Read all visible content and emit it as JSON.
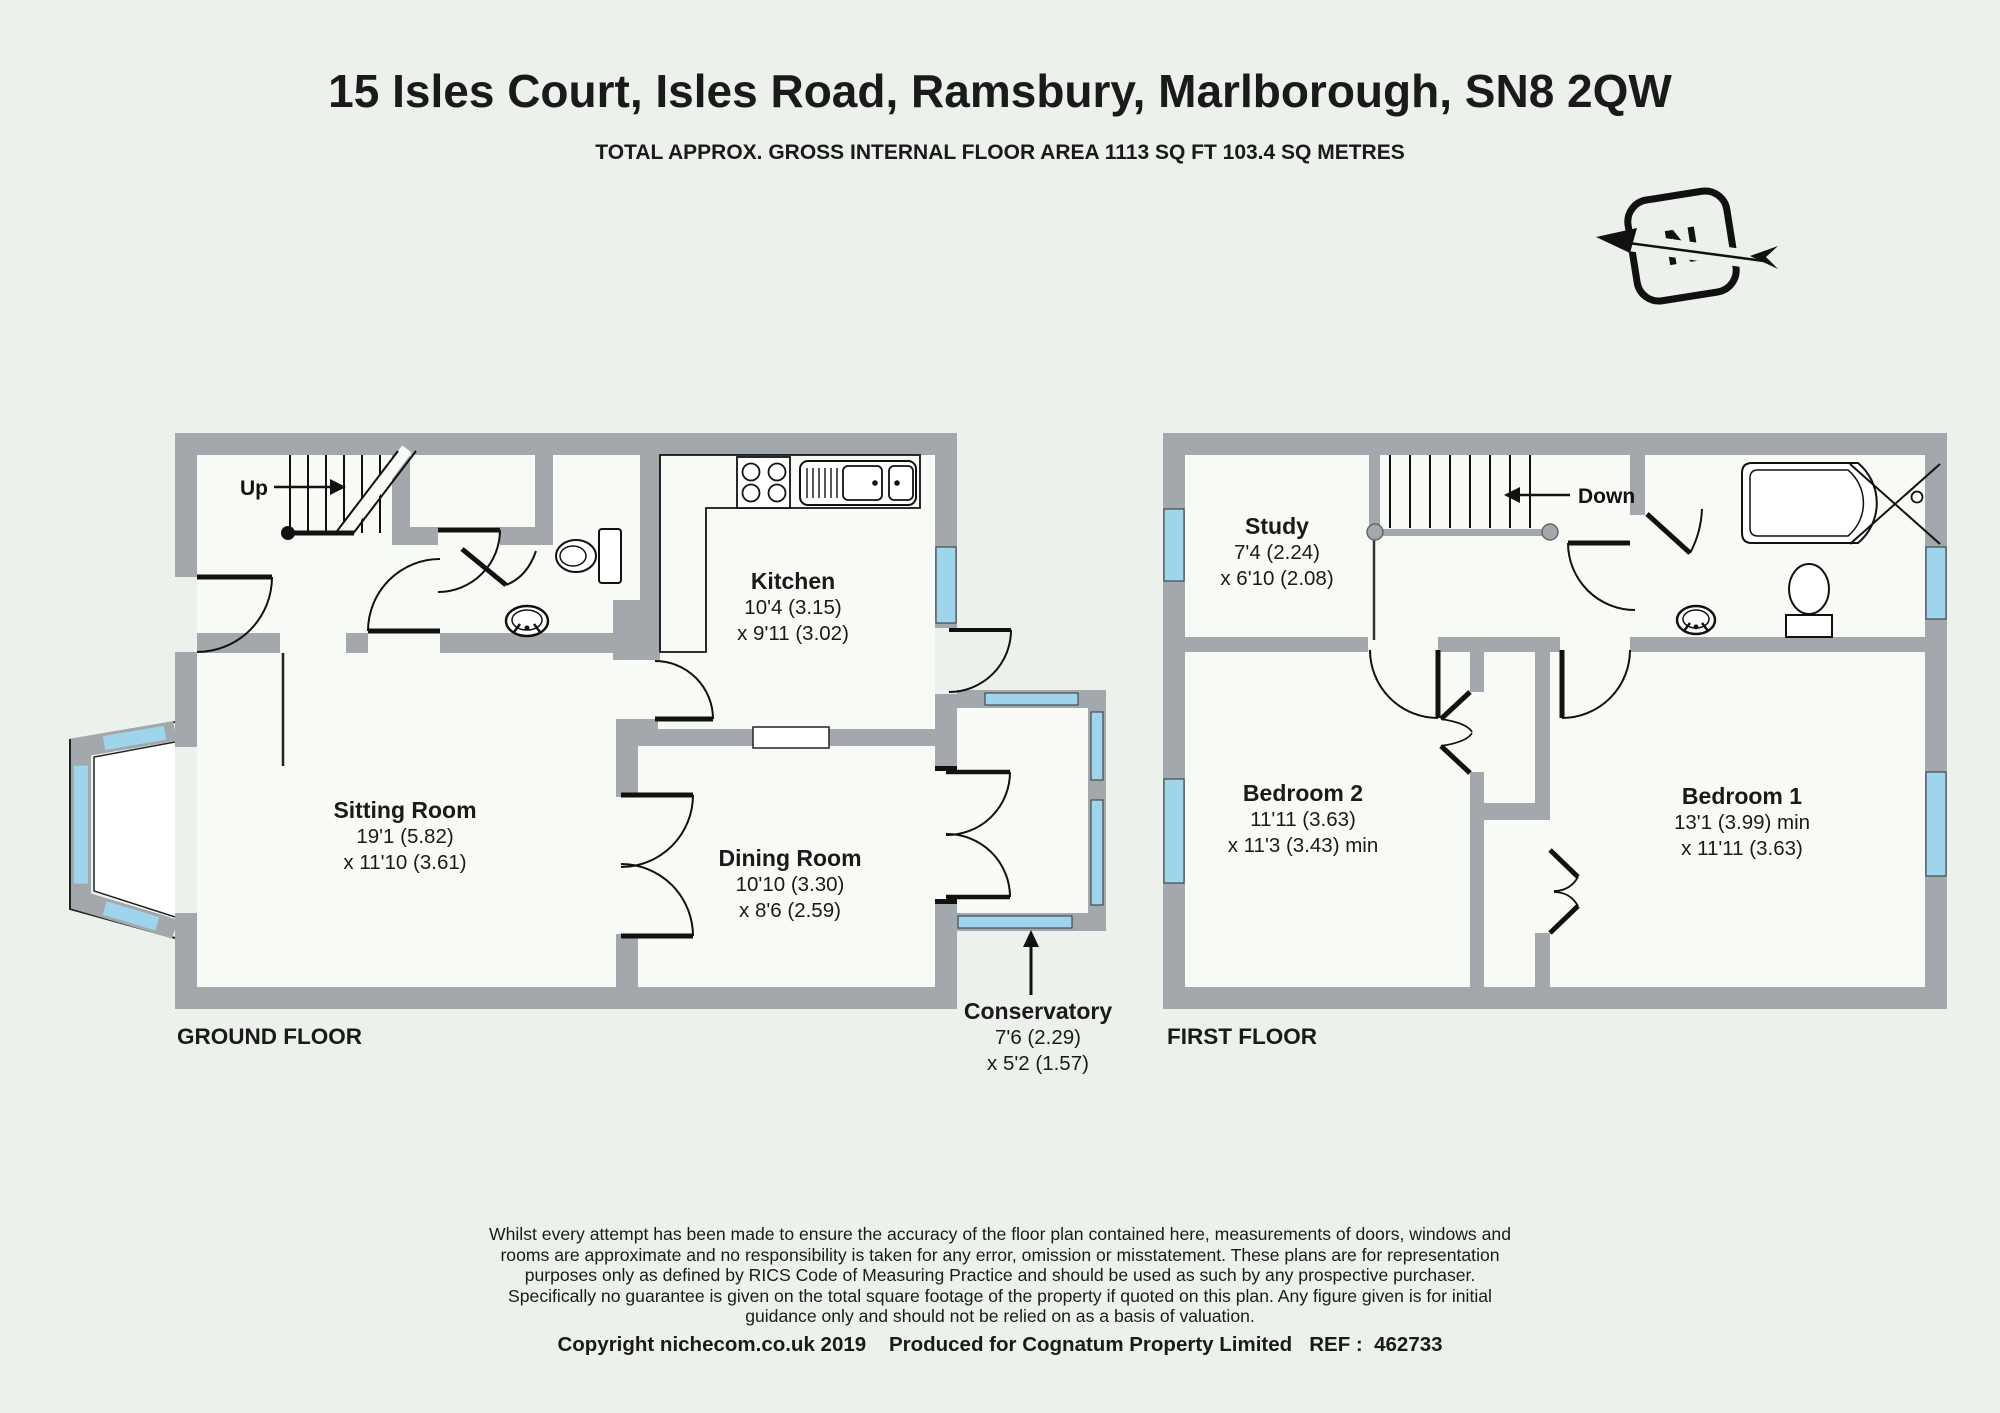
{
  "header": {
    "title": "15 Isles Court, Isles Road, Ramsbury, Marlborough, SN8 2QW",
    "subtitle": "TOTAL APPROX. GROSS INTERNAL FLOOR AREA 1113 SQ FT 103.4 SQ METRES"
  },
  "compass": {
    "letter": "N"
  },
  "ground_floor": {
    "label": "GROUND FLOOR",
    "stairs_direction": "Up",
    "rooms": {
      "sitting": {
        "name": "Sitting Room",
        "dim1": "19'1 (5.82)",
        "dim2": "x 11'10 (3.61)"
      },
      "kitchen": {
        "name": "Kitchen",
        "dim1": "10'4 (3.15)",
        "dim2": "x 9'11 (3.02)"
      },
      "dining": {
        "name": "Dining Room",
        "dim1": "10'10 (3.30)",
        "dim2": "x 8'6 (2.59)"
      },
      "conservatory": {
        "name": "Conservatory",
        "dim1": "7'6 (2.29)",
        "dim2": "x 5'2 (1.57)"
      }
    }
  },
  "first_floor": {
    "label": "FIRST FLOOR",
    "stairs_direction": "Down",
    "rooms": {
      "study": {
        "name": "Study",
        "dim1": "7'4 (2.24)",
        "dim2": "x 6'10 (2.08)"
      },
      "bedroom2": {
        "name": "Bedroom 2",
        "dim1": "11'11 (3.63)",
        "dim2": "x 11'3 (3.43) min"
      },
      "bedroom1": {
        "name": "Bedroom 1",
        "dim1": "13'1 (3.99) min",
        "dim2": "x 11'11 (3.63)"
      }
    }
  },
  "footer": {
    "disclaimer": "Whilst every attempt has been made to ensure the accuracy of the floor plan contained here, measurements of doors, windows and\nrooms are approximate and no responsibility is taken for any error, omission or misstatement. These plans are for representation\npurposes only as defined by RICS Code of Measuring Practice and should be used as such by any prospective purchaser.\nSpecifically no guarantee is given on the total square footage of the property if quoted on this plan. Any figure given is for initial\nguidance only and should not be relied on as a basis of valuation.",
    "copyright": "Copyright nichecom.co.uk 2019    Produced for Cognatum Property Limited   REF :  462733"
  },
  "colors": {
    "background": "#edf1ec",
    "wall_gray": "#a2a8ab",
    "window_blue": "#9fd5ec",
    "room_fill": "#f8faf6",
    "line_black": "#111111"
  }
}
